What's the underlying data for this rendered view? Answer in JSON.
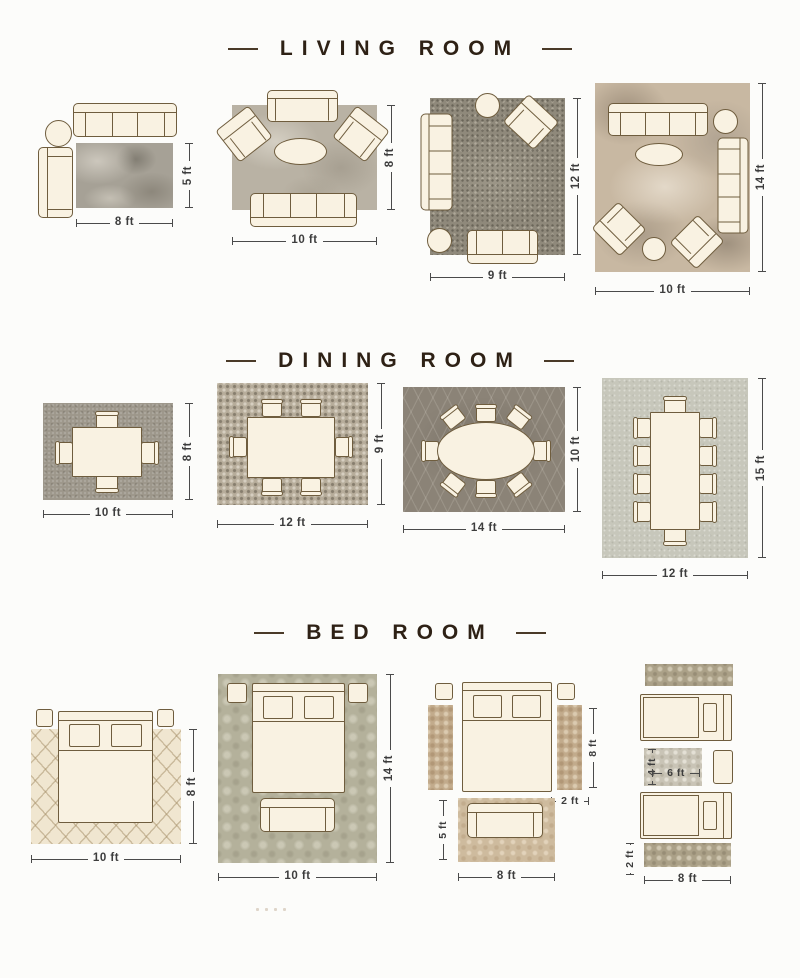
{
  "palette": {
    "background": "#fcfcfa",
    "title_ink": "#2e2115",
    "furniture_fill": "#f9f2e2",
    "furniture_outline": "#6f5d3e",
    "dimension_text": "#3d3d3d"
  },
  "titles": {
    "living": "LIVING ROOM",
    "dining": "DINING ROOM",
    "bed": "BED ROOM"
  },
  "living": {
    "l1": {
      "w": "8 ft",
      "h": "5 ft"
    },
    "l2": {
      "w": "10 ft",
      "h": "8 ft"
    },
    "l3": {
      "w": "9 ft",
      "h": "12 ft"
    },
    "l4": {
      "w": "10 ft",
      "h": "14 ft"
    }
  },
  "dining": {
    "d1": {
      "w": "10 ft",
      "h": "8 ft"
    },
    "d2": {
      "w": "12 ft",
      "h": "9 ft"
    },
    "d3": {
      "w": "14 ft",
      "h": "10 ft"
    },
    "d4": {
      "w": "12 ft",
      "h": "15 ft"
    }
  },
  "bed": {
    "b1": {
      "w": "10 ft",
      "h": "8 ft"
    },
    "b2": {
      "w": "10 ft",
      "h": "14 ft"
    },
    "b3": {
      "runner_h": "8 ft",
      "runner_w": "2 ft",
      "foot_w": "8 ft",
      "foot_h": "5 ft"
    },
    "b4": {
      "mid_h": "4 ft",
      "mid_w": "6 ft",
      "runner_w": "2 ft",
      "w": "8 ft"
    }
  }
}
